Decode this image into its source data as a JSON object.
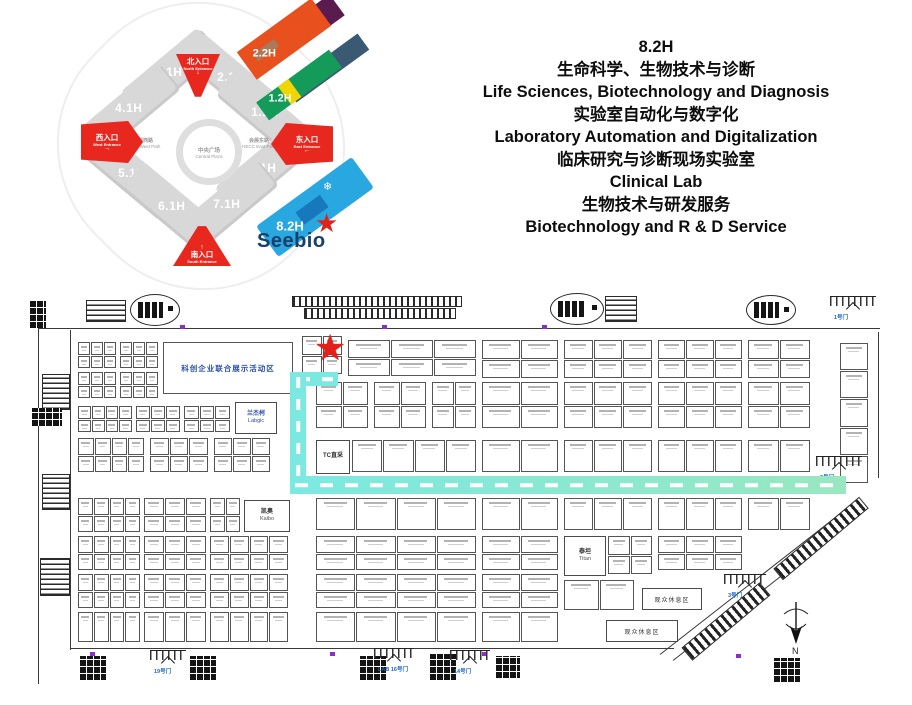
{
  "header": {
    "lines": [
      "8.2H",
      "生命科学、生物技术与诊断",
      "Life Sciences, Biotechnology and Diagnosis",
      "实验室自动化与数字化",
      "Laboratory Automation and Digitalization",
      "临床研究与诊断现场实验室",
      "Clinical Lab",
      "生物技术与研发服务",
      "Biotechnology and R & D Service"
    ]
  },
  "overview": {
    "halls": [
      {
        "label": "3.1H",
        "x": 84,
        "y": 56,
        "rot": -40
      },
      {
        "label": "4.1H",
        "x": 44,
        "y": 92,
        "rot": -40
      },
      {
        "label": "2.1H",
        "x": 146,
        "y": 61,
        "rot": 40
      },
      {
        "label": "1.1H",
        "x": 180,
        "y": 96,
        "rot": 40
      },
      {
        "label": "5.1H",
        "x": 47,
        "y": 157,
        "rot": 40
      },
      {
        "label": "6.1H",
        "x": 87,
        "y": 190,
        "rot": 40
      },
      {
        "label": "8.1H",
        "x": 178,
        "y": 152,
        "rot": -40
      },
      {
        "label": "7.1H",
        "x": 142,
        "y": 188,
        "rot": -40
      }
    ],
    "center": {
      "zh": "中央广场",
      "en": "Central Plaza"
    },
    "west_path": {
      "zh": "会展西路",
      "en": "NECC West Path"
    },
    "east_path": {
      "zh": "会展东路",
      "en": "NECC East Path"
    },
    "entrances": {
      "north": {
        "zh": "北入口",
        "en": "North Entrance",
        "arrow": "↓"
      },
      "south": {
        "zh": "南入口",
        "en": "South Entrance",
        "arrow": "↑"
      },
      "west": {
        "zh": "西入口",
        "en": "West Entrance",
        "arrow": "→"
      },
      "east": {
        "zh": "东入口",
        "en": "East Entrance",
        "arrow": "←"
      }
    },
    "floating": {
      "h22": "2.2H",
      "h12": "1.2H",
      "h82": "8.2H",
      "snowflake": "❄",
      "star": "★",
      "brand": "Seebio"
    },
    "colors": {
      "hall_gray": "#d8d8d8",
      "entrance_red": "#e8281e",
      "h22": "#e8501e",
      "h22_back": "#5a1c4e",
      "h22_stripe": "#a9795a",
      "h12": "#149a59",
      "h12_back": "#3a5a74",
      "h12_stripe": "#f0d500",
      "h82": "#29a7e0",
      "h82_inner": "#1878bc",
      "brand_color": "#14406b",
      "star_red": "#e32119"
    }
  },
  "floorplan": {
    "star": {
      "glyph": "★",
      "x": 284,
      "y": 42,
      "color": "#e32119"
    },
    "big_area": {
      "label": "科创企业联合展示活动区",
      "x": 133,
      "y": 54,
      "w": 128,
      "h": 50
    },
    "landmarks": [
      {
        "id": "booth-tc-zhicai",
        "l1": "TC直采",
        "l2": "",
        "x": 286,
        "y": 152,
        "w": 32,
        "h": 32,
        "blue": false
      },
      {
        "id": "booth-labgic",
        "l1": "兰杰柯",
        "l2": "Labgic",
        "x": 205,
        "y": 114,
        "w": 40,
        "h": 30,
        "blue": true
      },
      {
        "id": "booth-kaibo",
        "l1": "凯奥",
        "l2": "Kaibo",
        "x": 214,
        "y": 212,
        "w": 44,
        "h": 30,
        "blue": false
      },
      {
        "id": "booth-titan",
        "l1": "泰坦",
        "l2": "Titan",
        "x": 534,
        "y": 248,
        "w": 40,
        "h": 38,
        "blue": false
      }
    ],
    "rest_areas": [
      {
        "label": "观众休息区",
        "x": 612,
        "y": 300,
        "w": 58,
        "h": 20
      },
      {
        "label": "观众休息区",
        "x": 576,
        "y": 332,
        "w": 70,
        "h": 20
      }
    ],
    "gates": [
      {
        "label": "1号门",
        "x": 800,
        "y": 8,
        "w": 46
      },
      {
        "label": "2号门",
        "x": 786,
        "y": 168,
        "w": 46
      },
      {
        "label": "3号门",
        "x": 694,
        "y": 286,
        "w": 42
      },
      {
        "label": "19号门",
        "x": 120,
        "y": 362,
        "w": 36
      },
      {
        "label": "LAB 16号门",
        "x": 344,
        "y": 360,
        "w": 40
      },
      {
        "label": "14号门",
        "x": 420,
        "y": 362,
        "w": 40
      }
    ],
    "grids": [
      [
        272,
        48,
        40,
        38,
        2,
        2
      ],
      [
        48,
        54,
        38,
        26,
        3,
        2
      ],
      [
        90,
        54,
        38,
        26,
        3,
        2
      ],
      [
        48,
        84,
        38,
        26,
        3,
        2
      ],
      [
        90,
        84,
        38,
        26,
        3,
        2
      ],
      [
        48,
        118,
        54,
        26,
        4,
        2
      ],
      [
        106,
        118,
        44,
        26,
        3,
        2
      ],
      [
        154,
        118,
        46,
        26,
        3,
        2
      ],
      [
        48,
        150,
        66,
        34,
        4,
        2
      ],
      [
        120,
        150,
        58,
        34,
        3,
        2
      ],
      [
        184,
        150,
        56,
        34,
        3,
        2
      ],
      [
        48,
        210,
        62,
        34,
        4,
        2
      ],
      [
        114,
        210,
        62,
        34,
        3,
        2
      ],
      [
        180,
        210,
        30,
        34,
        2,
        2
      ],
      [
        48,
        248,
        62,
        34,
        4,
        2
      ],
      [
        114,
        248,
        62,
        34,
        3,
        2
      ],
      [
        180,
        248,
        78,
        34,
        4,
        2
      ],
      [
        48,
        286,
        62,
        34,
        4,
        2
      ],
      [
        114,
        286,
        62,
        34,
        3,
        2
      ],
      [
        180,
        286,
        78,
        34,
        4,
        2
      ],
      [
        48,
        324,
        62,
        30,
        4,
        1
      ],
      [
        114,
        324,
        62,
        30,
        3,
        1
      ],
      [
        180,
        324,
        78,
        30,
        4,
        1
      ],
      [
        318,
        52,
        128,
        36,
        3,
        2
      ],
      [
        286,
        94,
        52,
        46,
        2,
        2
      ],
      [
        344,
        94,
        52,
        46,
        2,
        2
      ],
      [
        402,
        94,
        44,
        46,
        2,
        2
      ],
      [
        322,
        152,
        124,
        32,
        4,
        1
      ],
      [
        286,
        210,
        160,
        32,
        4,
        1
      ],
      [
        286,
        248,
        160,
        34,
        4,
        2
      ],
      [
        286,
        286,
        160,
        34,
        4,
        2
      ],
      [
        286,
        324,
        160,
        30,
        4,
        1
      ],
      [
        452,
        52,
        76,
        38,
        2,
        2
      ],
      [
        452,
        94,
        76,
        46,
        2,
        2
      ],
      [
        452,
        152,
        76,
        32,
        2,
        1
      ],
      [
        452,
        210,
        76,
        32,
        2,
        1
      ],
      [
        452,
        248,
        76,
        34,
        2,
        2
      ],
      [
        452,
        286,
        76,
        34,
        2,
        2
      ],
      [
        452,
        324,
        76,
        30,
        2,
        1
      ],
      [
        534,
        52,
        88,
        38,
        3,
        2
      ],
      [
        534,
        94,
        88,
        46,
        3,
        2
      ],
      [
        534,
        152,
        88,
        32,
        3,
        1
      ],
      [
        534,
        210,
        88,
        32,
        3,
        1
      ],
      [
        578,
        248,
        44,
        38,
        2,
        2
      ],
      [
        534,
        292,
        70,
        30,
        2,
        1
      ],
      [
        628,
        52,
        84,
        38,
        3,
        2
      ],
      [
        628,
        94,
        84,
        46,
        3,
        2
      ],
      [
        628,
        152,
        84,
        32,
        3,
        1
      ],
      [
        628,
        210,
        84,
        32,
        3,
        1
      ],
      [
        628,
        248,
        84,
        34,
        3,
        2
      ],
      [
        718,
        52,
        62,
        38,
        2,
        2
      ],
      [
        718,
        94,
        62,
        46,
        2,
        2
      ],
      [
        718,
        152,
        62,
        32,
        2,
        1
      ],
      [
        718,
        210,
        62,
        32,
        2,
        1
      ],
      [
        810,
        55,
        28,
        140,
        1,
        5
      ]
    ],
    "lines": [
      [
        8,
        40,
        842,
        1
      ],
      [
        8,
        28,
        1,
        368
      ],
      [
        40,
        42,
        1,
        320
      ],
      [
        40,
        360,
        604,
        1
      ],
      [
        848,
        44,
        1,
        146
      ]
    ],
    "diag_lines": [
      {
        "x": 630,
        "y": 366,
        "w": 238,
        "rot": -38
      },
      {
        "x": 643,
        "y": 372,
        "w": 238,
        "rot": -38
      }
    ],
    "ovals": [
      [
        100,
        6,
        48,
        30
      ],
      [
        520,
        5,
        52,
        30
      ],
      [
        716,
        7,
        48,
        28
      ]
    ],
    "stairs": [
      [
        56,
        12,
        38,
        20
      ],
      [
        575,
        8,
        30,
        24
      ],
      [
        12,
        86,
        26,
        34
      ],
      [
        12,
        186,
        26,
        34
      ],
      [
        10,
        270,
        28,
        36
      ]
    ],
    "escalators": [
      [
        262,
        8,
        168,
        9
      ],
      [
        274,
        20,
        150,
        9
      ]
    ],
    "blocks": [
      [
        50,
        368,
        26,
        24
      ],
      [
        160,
        368,
        26,
        24
      ],
      [
        330,
        368,
        26,
        24
      ],
      [
        400,
        366,
        26,
        26
      ],
      [
        466,
        368,
        24,
        22
      ],
      [
        744,
        370,
        26,
        24
      ],
      [
        0,
        12,
        16,
        28
      ],
      [
        2,
        120,
        30,
        18
      ]
    ],
    "hatches": [
      {
        "x": 645,
        "y": 325,
        "w": 100,
        "h": 15,
        "rot": -40
      },
      {
        "x": 735,
        "y": 243,
        "w": 110,
        "h": 13,
        "rot": -40
      }
    ],
    "ticks": [
      [
        150,
        37
      ],
      [
        352,
        37
      ],
      [
        512,
        37
      ],
      [
        60,
        364
      ],
      [
        300,
        364
      ],
      [
        452,
        364
      ],
      [
        706,
        366
      ]
    ],
    "route": {
      "segments": [
        {
          "dir": "h",
          "x": 262,
          "y": 84,
          "w": 46,
          "h": 14
        },
        {
          "dir": "v",
          "x": 260,
          "y": 84,
          "w": 16,
          "h": 120
        },
        {
          "dir": "h",
          "x": 260,
          "y": 188,
          "w": 556,
          "h": 18
        }
      ],
      "color_start": "#7ce9e1",
      "color_end": "#99e7c0"
    },
    "compass_label": "N"
  }
}
